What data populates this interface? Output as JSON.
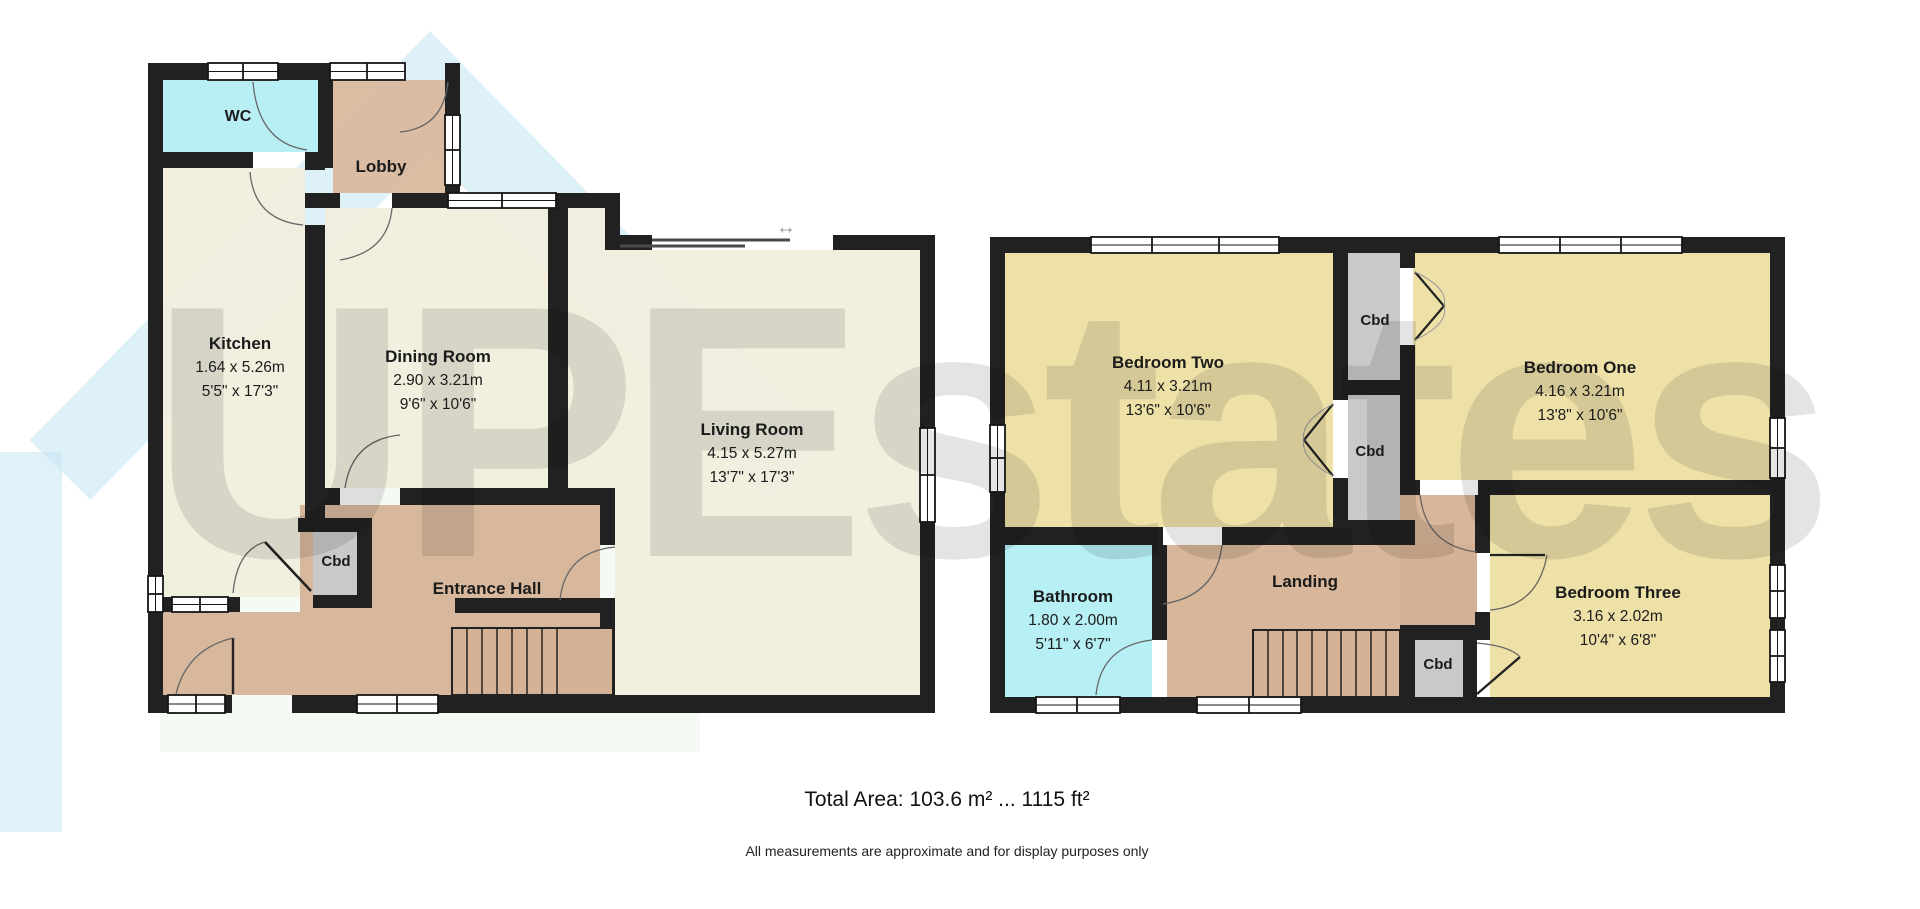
{
  "watermark": "UPEstates",
  "symbols": {
    "patio_arrow": "↔"
  },
  "colors": {
    "wall": "#212121",
    "room_cream": "#f1eddb",
    "room_tan": "#d5b295",
    "lobby_tan": "#d8b79b",
    "room_cyan": "#b2eef3",
    "room_yellow": "#ecdfa3",
    "cupboard_grey": "#c9c9c9",
    "logo_blue": "#c3e3f2",
    "logo_green": "#d4e9d2"
  },
  "ground_floor": {
    "rooms": {
      "wc": {
        "label": "WC"
      },
      "lobby": {
        "label": "Lobby"
      },
      "kitchen": {
        "label": "Kitchen",
        "size_metric": "1.64 x 5.26m",
        "size_imperial": "5'5\" x 17'3\""
      },
      "dining": {
        "label": "Dining Room",
        "size_metric": "2.90 x 3.21m",
        "size_imperial": "9'6\" x 10'6\""
      },
      "living": {
        "label": "Living Room",
        "size_metric": "4.15 x 5.27m",
        "size_imperial": "13'7\" x 17'3\""
      },
      "cbd": {
        "label": "Cbd"
      },
      "hall": {
        "label": "Entrance Hall"
      }
    }
  },
  "first_floor": {
    "rooms": {
      "bedroom_two": {
        "label": "Bedroom Two",
        "size_metric": "4.11 x 3.21m",
        "size_imperial": "13'6\" x 10'6\""
      },
      "bedroom_one": {
        "label": "Bedroom One",
        "size_metric": "4.16 x 3.21m",
        "size_imperial": "13'8\" x 10'6\""
      },
      "cbd_top": {
        "label": "Cbd"
      },
      "cbd_mid": {
        "label": "Cbd"
      },
      "bathroom": {
        "label": "Bathroom",
        "size_metric": "1.80 x 2.00m",
        "size_imperial": "5'11\" x 6'7\""
      },
      "landing": {
        "label": "Landing"
      },
      "bedroom_three": {
        "label": "Bedroom Three",
        "size_metric": "3.16 x 2.02m",
        "size_imperial": "10'4\" x 6'8\""
      },
      "cbd_small": {
        "label": "Cbd"
      }
    }
  },
  "footer": {
    "total_area": "Total Area: 103.6 m² ... 1115 ft²",
    "disclaimer": "All measurements are approximate and for display purposes only"
  }
}
